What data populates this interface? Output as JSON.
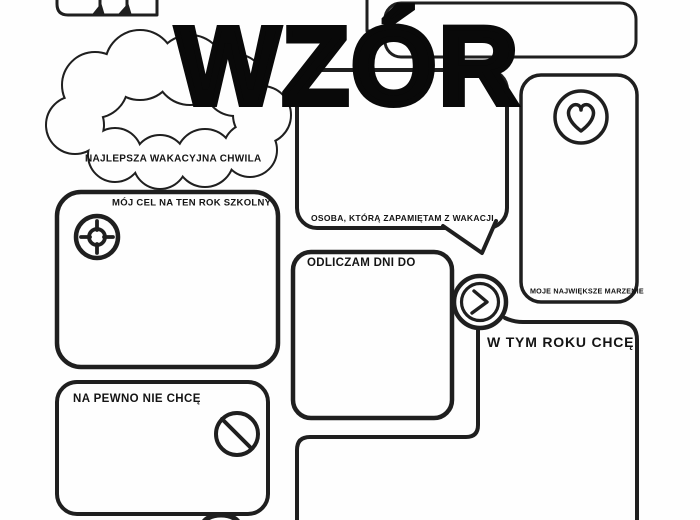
{
  "document": {
    "kind": "school-year worksheet template (Polish)",
    "watermark": "WZÓR"
  },
  "colors": {
    "ink": "#1f1f1f",
    "paper": "#fefefe",
    "watermark_ink": "#090909"
  },
  "sections": {
    "best_moment": {
      "label": "NAJLEPSZA WAKACYJNA CHWILA",
      "shape": "cloud"
    },
    "person": {
      "label": "OSOBA, KTÓRĄ ZAPAMIĘTAM Z WAKACJI",
      "shape": "speech-bubble"
    },
    "dream": {
      "label": "MOJE NAJWIĘKSZE MARZENIE",
      "icon": "heart-icon"
    },
    "goal": {
      "label": "MÓJ CEL NA TEN ROK SZKOLNY",
      "icon": "target-icon"
    },
    "countdown": {
      "label": "ODLICZAM DNI DO",
      "icon": "clock-icon"
    },
    "this_year": {
      "label": "W TYM ROKU CHCĘ"
    },
    "dont_want": {
      "label": "NA PEWNO NIE CHCĘ",
      "icon": "no-entry-icon"
    }
  },
  "icons": {
    "heart": "heart-icon",
    "target": "target-icon",
    "clock": "clock-icon",
    "no_entry": "no-entry-icon"
  }
}
